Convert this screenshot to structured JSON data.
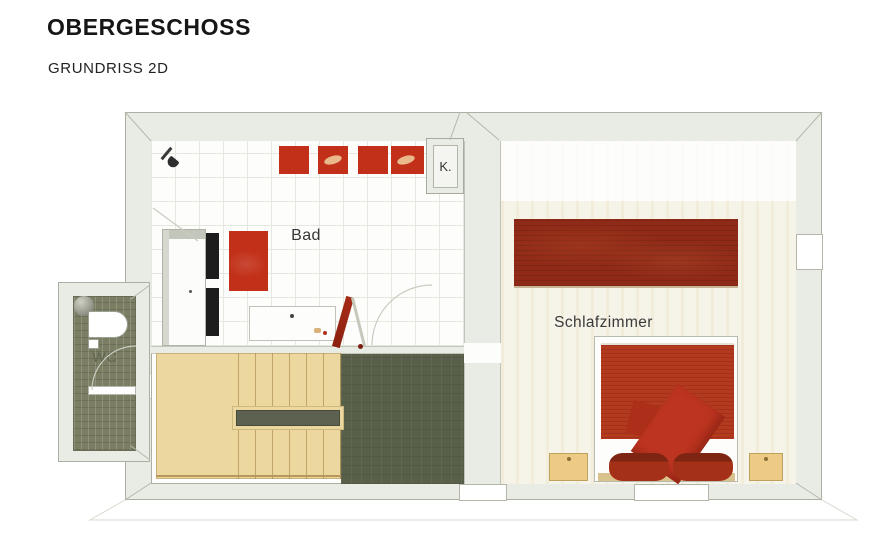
{
  "page": {
    "title": "OBERGESCHOSS",
    "subtitle": "GRUNDRISS 2D"
  },
  "plan": {
    "labels": {
      "bathroom": "Bad",
      "bedroom": "Schlafzimmer",
      "wc": "WC",
      "closet": "K."
    }
  },
  "colors": {
    "wall-fill": "#e9ebe5",
    "wall-line": "#aab0a2",
    "floor-white": "#fdfdfb",
    "tile-line": "#e4e8df",
    "bedroom-floor": "#f6f3e8",
    "accent-red": "#c23019",
    "mat-red": "#c23019",
    "wardrobe-red": "#8e2a17",
    "bed-red": "#b43a1f",
    "pillow-red": "#a43018",
    "duvet-red": "#bd3520",
    "stair-wood": "#ecd79e",
    "stair-line": "#b7985c",
    "handrail-olive": "#5c6150",
    "hall-floor": "#59604a",
    "wc-floor": "#7b7e63",
    "nightstand-tan": "#edcb84",
    "ink": "#2c2c2c",
    "wc-ink": "#60634e"
  }
}
